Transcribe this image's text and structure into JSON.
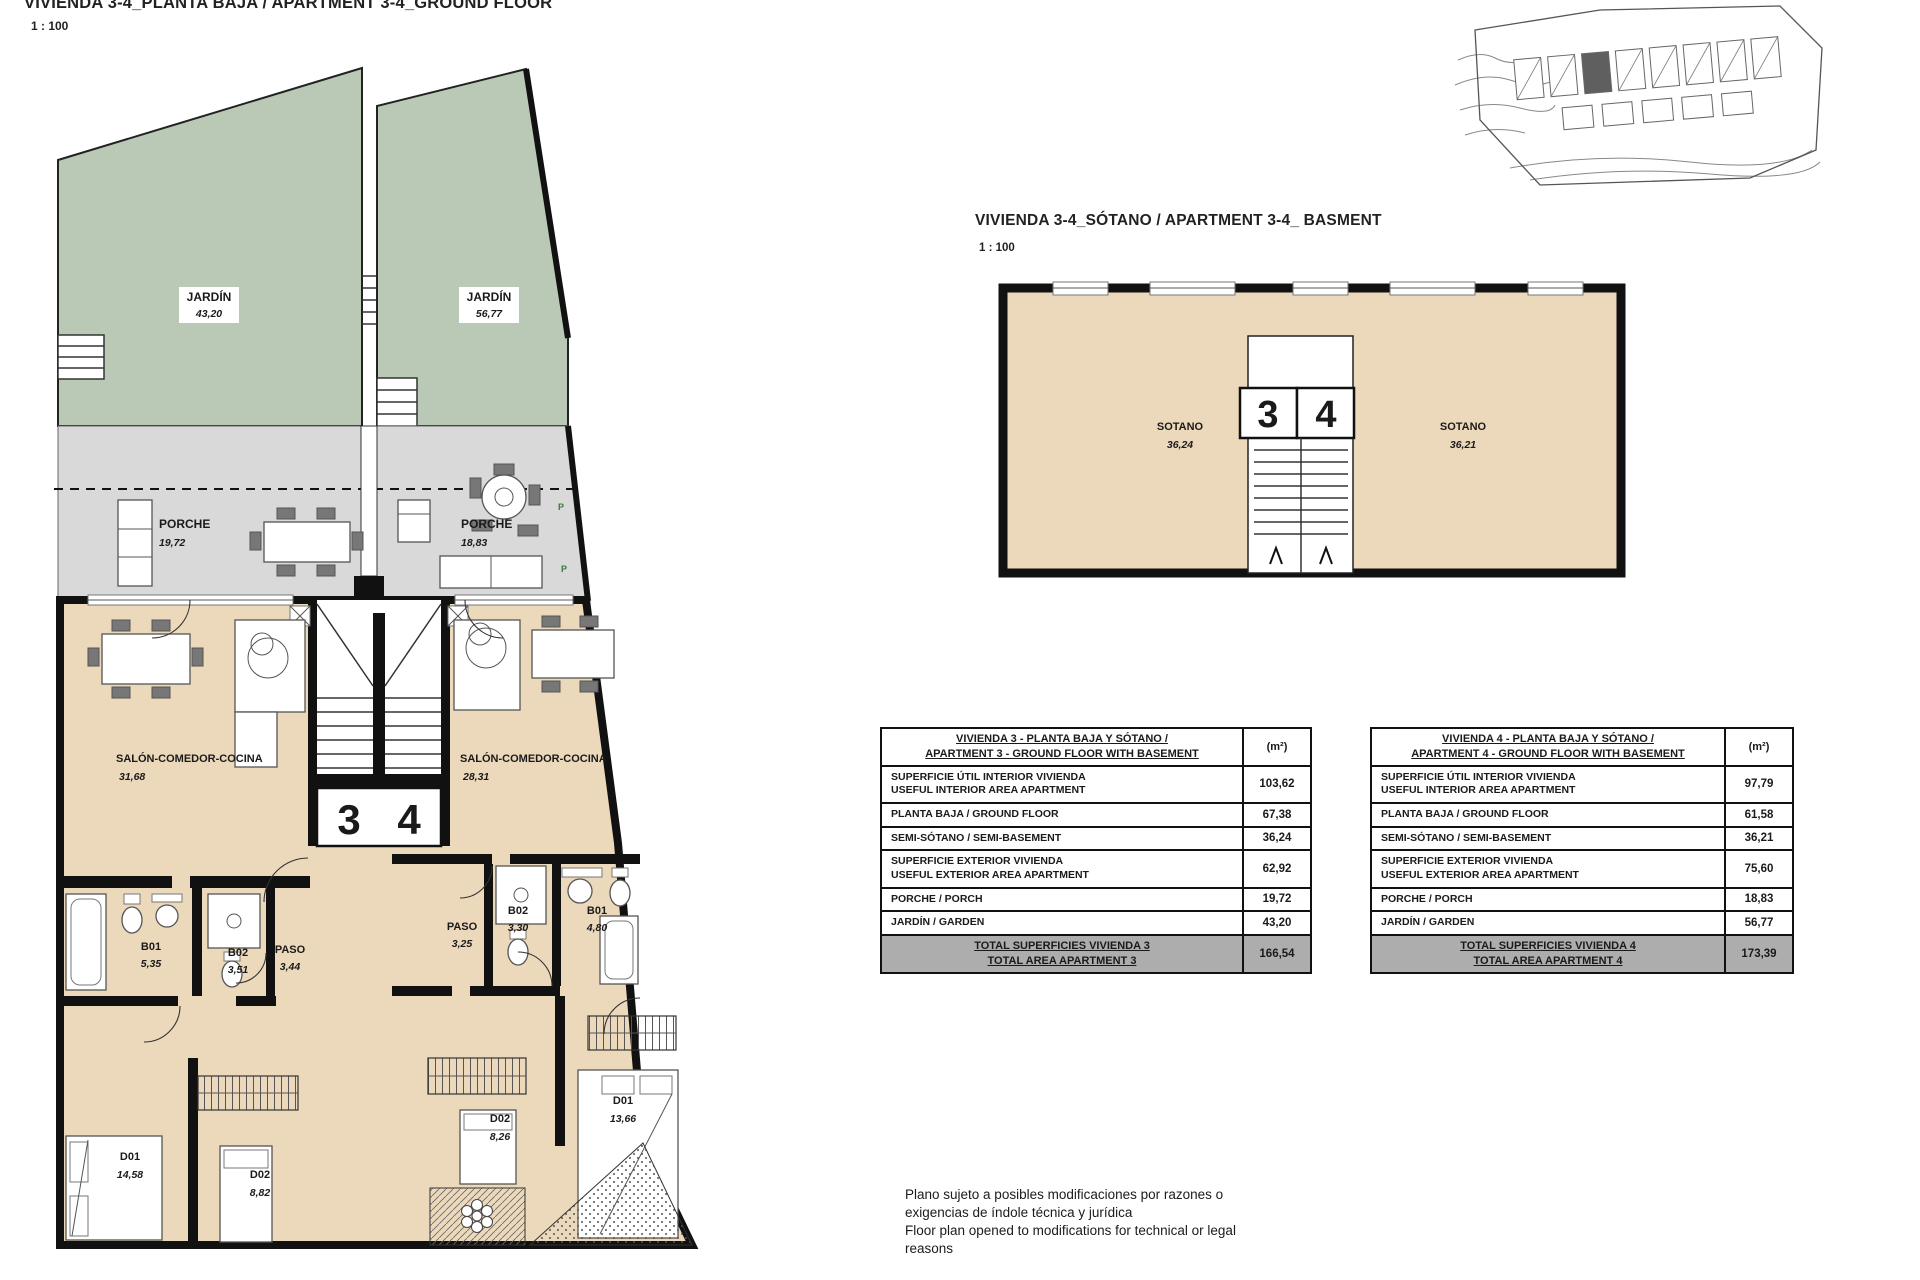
{
  "colors": {
    "garden_green": "#bac9b5",
    "porch_gray": "#d9d9d9",
    "interior_beige": "#ecd9bb",
    "wall_black": "#111111",
    "table_total_gray": "#adadad"
  },
  "ground_floor": {
    "title": "VIVIENDA 3-4_PLANTA BAJA / APARTMENT 3-4_GROUND FLOOR",
    "scale": "1 : 100",
    "unit_left_number": "3",
    "unit_right_number": "4",
    "p_mark": "P",
    "labels": {
      "jardin_left": {
        "name": "JARDÍN",
        "area": "43,20"
      },
      "jardin_right": {
        "name": "JARDÍN",
        "area": "56,77"
      },
      "porche_left": {
        "name": "PORCHE",
        "area": "19,72"
      },
      "porche_right": {
        "name": "PORCHE",
        "area": "18,83"
      },
      "salon_left": {
        "name": "SALÓN-COMEDOR-COCINA",
        "area": "31,68"
      },
      "salon_right": {
        "name": "SALÓN-COMEDOR-COCINA",
        "area": "28,31"
      },
      "b01_left": {
        "name": "B01",
        "area": "5,35"
      },
      "b02_left": {
        "name": "B02",
        "area": "3,51"
      },
      "paso_left": {
        "name": "PASO",
        "area": "3,44"
      },
      "d01_left": {
        "name": "D01",
        "area": "14,58"
      },
      "d02_left": {
        "name": "D02",
        "area": "8,82"
      },
      "paso_right": {
        "name": "PASO",
        "area": "3,25"
      },
      "b02_right": {
        "name": "B02",
        "area": "3,30"
      },
      "b01_right": {
        "name": "B01",
        "area": "4,80"
      },
      "d02_right": {
        "name": "D02",
        "area": "8,26"
      },
      "d01_right": {
        "name": "D01",
        "area": "13,66"
      }
    }
  },
  "basement": {
    "title": "VIVIENDA 3-4_SÓTANO / APARTMENT 3-4_ BASMENT",
    "scale": "1 : 100",
    "unit_left_number": "3",
    "unit_right_number": "4",
    "labels": {
      "sotano_left": {
        "name": "SOTANO",
        "area": "36,24"
      },
      "sotano_right": {
        "name": "SOTANO",
        "area": "36,21"
      }
    }
  },
  "tables": [
    {
      "title_line1": "VIVIENDA 3 - PLANTA BAJA Y SÓTANO /",
      "title_line2": "APARTMENT 3 - GROUND FLOOR WITH BASEMENT",
      "unit_header": "(m²)",
      "rows": [
        {
          "label1": "SUPERFICIE ÚTIL INTERIOR VIVIENDA",
          "label2": "USEFUL INTERIOR AREA APARTMENT",
          "value": "103,62"
        },
        {
          "label1": "PLANTA BAJA / GROUND FLOOR",
          "label2": "",
          "value": "67,38"
        },
        {
          "label1": "SEMI-SÓTANO / SEMI-BASEMENT",
          "label2": "",
          "value": "36,24"
        },
        {
          "label1": "SUPERFICIE EXTERIOR VIVIENDA",
          "label2": "USEFUL EXTERIOR AREA APARTMENT",
          "value": "62,92"
        },
        {
          "label1": "PORCHE / PORCH",
          "label2": "",
          "value": "19,72"
        },
        {
          "label1": "JARDÍN / GARDEN",
          "label2": "",
          "value": "43,20"
        }
      ],
      "total_label1": "TOTAL SUPERFICIES VIVIENDA 3",
      "total_label2": "TOTAL AREA APARTMENT 3",
      "total_value": "166,54"
    },
    {
      "title_line1": "VIVIENDA 4 - PLANTA BAJA Y SÓTANO /",
      "title_line2": "APARTMENT 4 - GROUND FLOOR WITH BASEMENT",
      "unit_header": "(m²)",
      "rows": [
        {
          "label1": "SUPERFICIE ÚTIL INTERIOR VIVIENDA",
          "label2": "USEFUL INTERIOR AREA APARTMENT",
          "value": "97,79"
        },
        {
          "label1": "PLANTA BAJA / GROUND FLOOR",
          "label2": "",
          "value": "61,58"
        },
        {
          "label1": "SEMI-SÓTANO / SEMI-BASEMENT",
          "label2": "",
          "value": "36,21"
        },
        {
          "label1": "SUPERFICIE EXTERIOR VIVIENDA",
          "label2": "USEFUL EXTERIOR AREA APARTMENT",
          "value": "75,60"
        },
        {
          "label1": "PORCHE / PORCH",
          "label2": "",
          "value": "18,83"
        },
        {
          "label1": "JARDÍN / GARDEN",
          "label2": "",
          "value": "56,77"
        }
      ],
      "total_label1": "TOTAL SUPERFICIES VIVIENDA 4",
      "total_label2": "TOTAL AREA APARTMENT 4",
      "total_value": "173,39"
    }
  ],
  "disclaimer": {
    "line1": "Plano sujeto a posibles modificaciones por razones o",
    "line2": "exigencias de índole técnica y jurídica",
    "line3": "Floor plan opened to modifications for technical or legal",
    "line4": "reasons"
  }
}
